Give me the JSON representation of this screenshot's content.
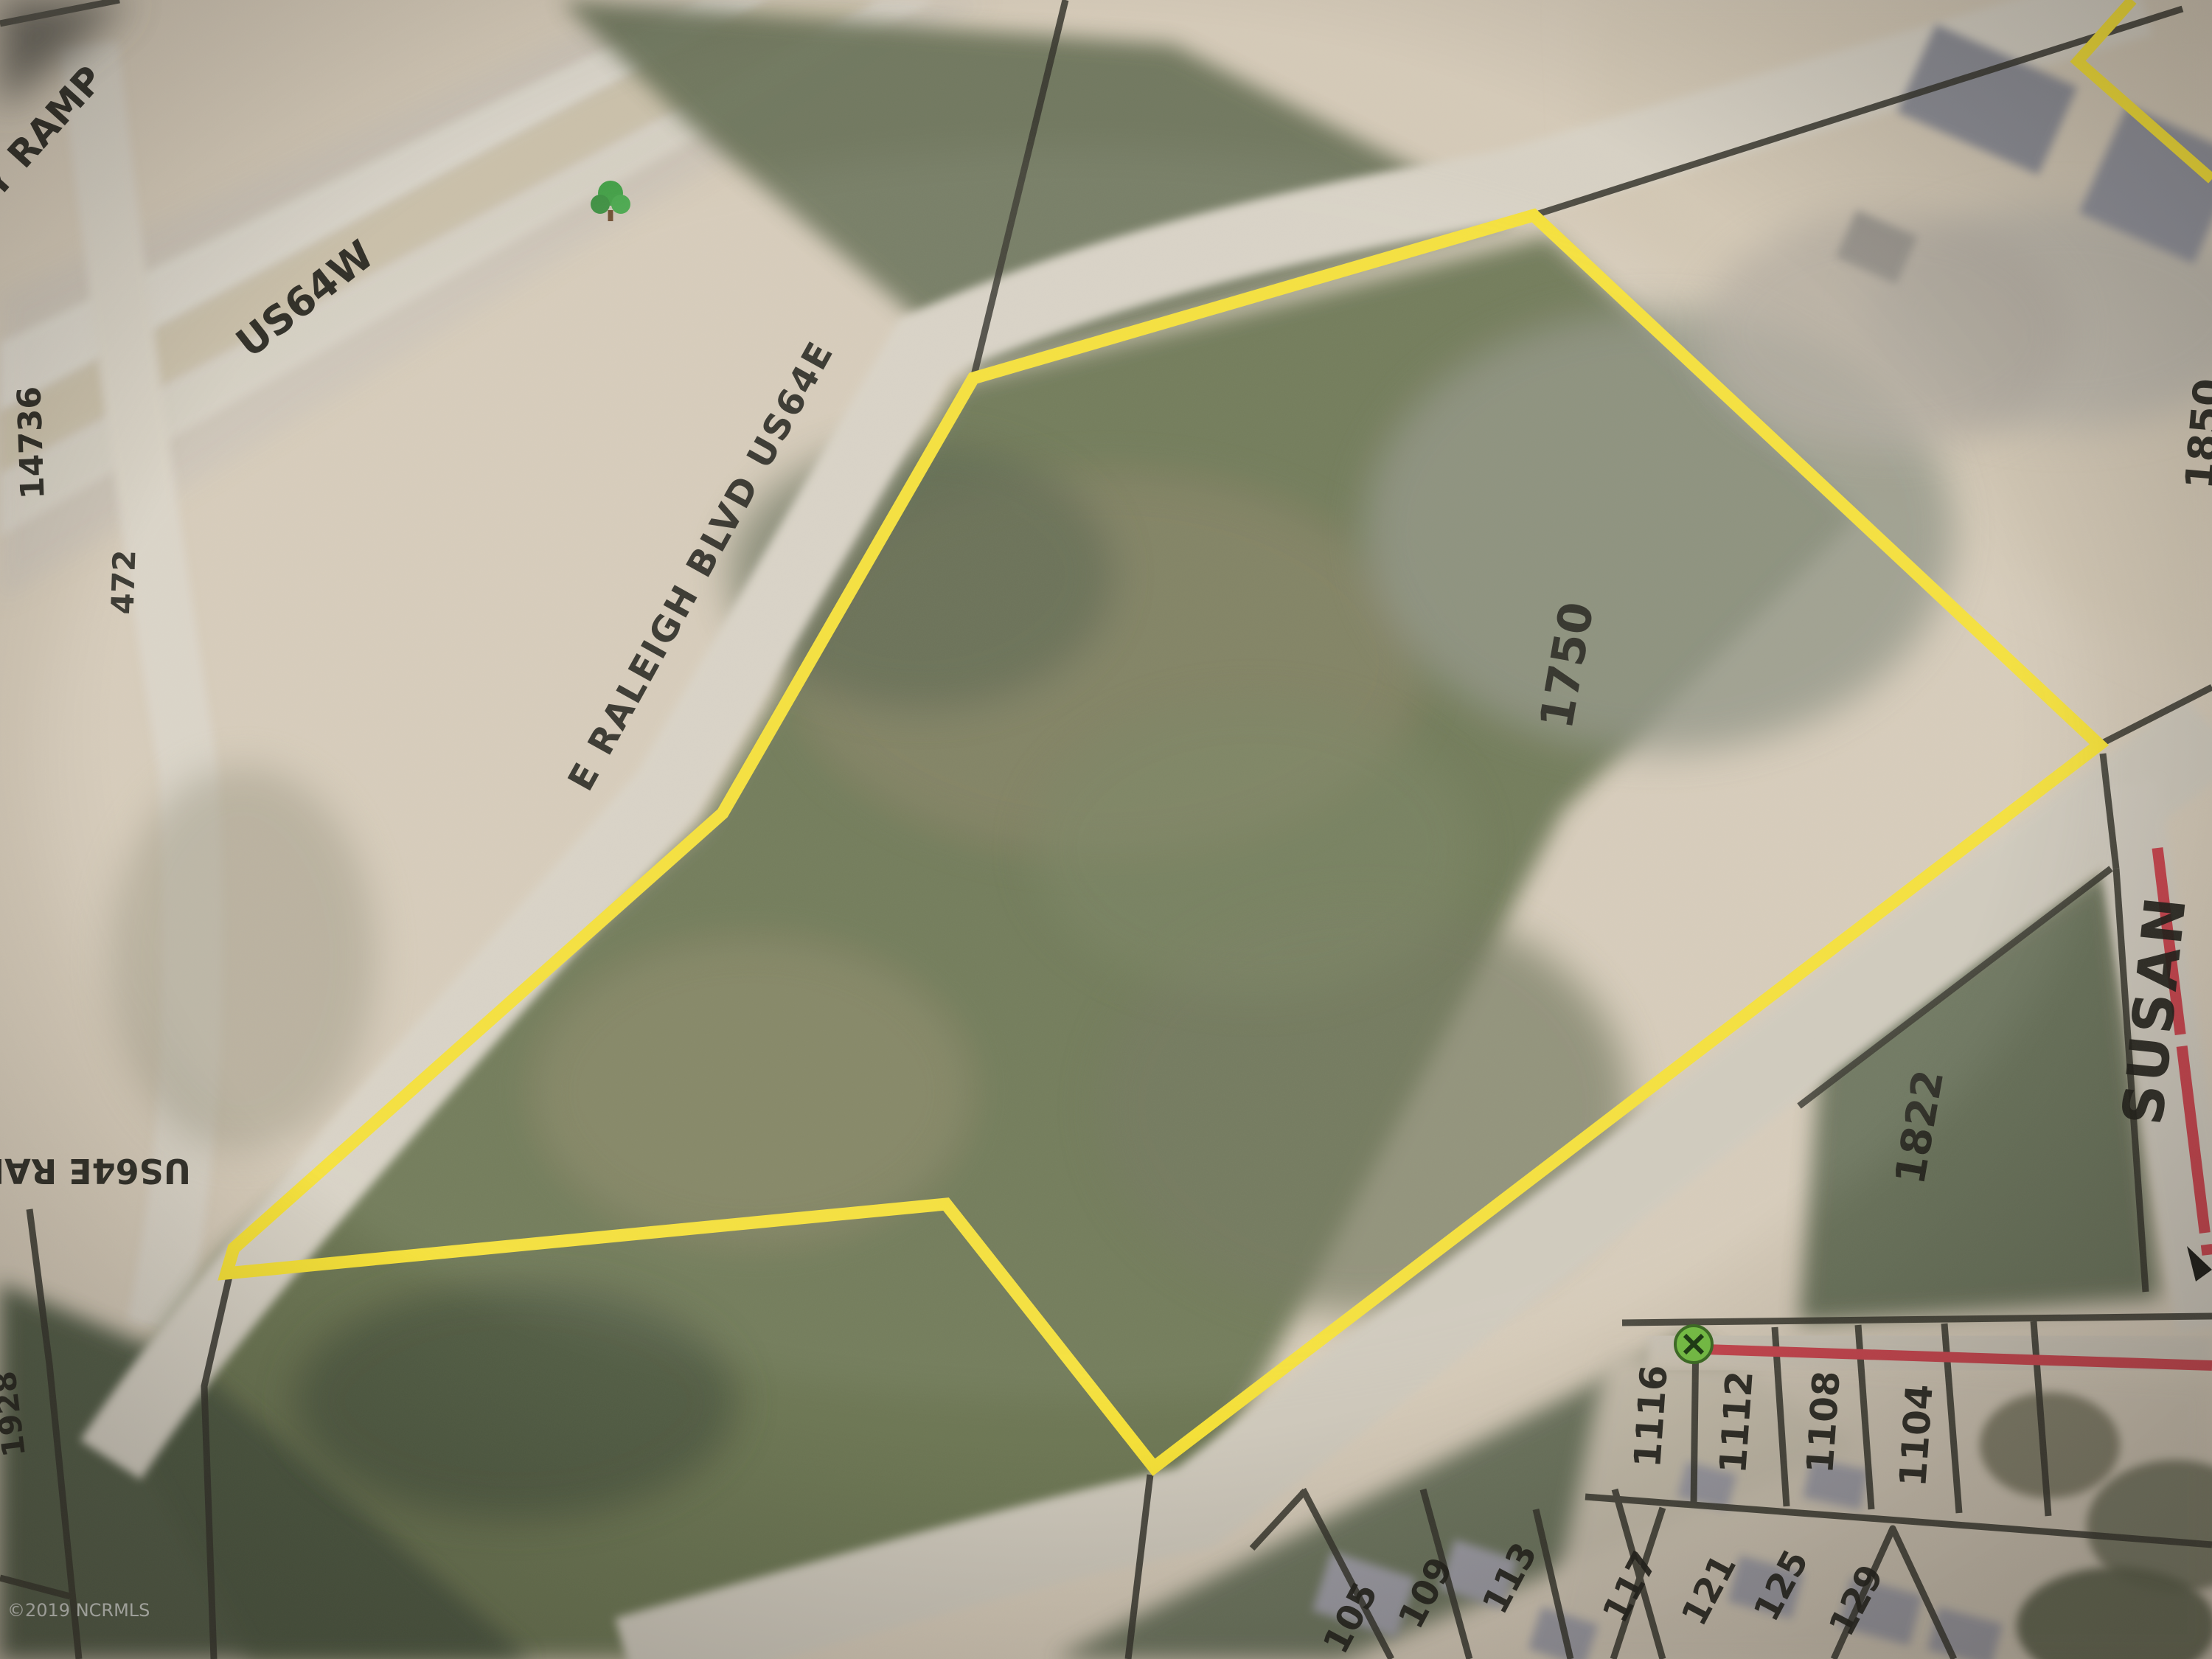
{
  "map": {
    "watermark": "©2019 NCRMLS",
    "streets": {
      "ramp": "Y RAMP",
      "us64w": "US64W",
      "e_raleigh_blvd": "E RALEIGH BLVD US64E",
      "us64e_raleigh_partial": "US64E RAL",
      "susan": "SUSAN"
    },
    "route_segment_ids": {
      "segment_a": "14736",
      "segment_b": "472"
    },
    "parcels": {
      "subject_parcel": "1750",
      "neighbor_right": "1822",
      "neighbor_left": "1928",
      "edge_partial": "1850",
      "front_row": [
        "1116",
        "1112",
        "1108",
        "1104"
      ],
      "second_row": [
        "117",
        "121",
        "125",
        "129"
      ],
      "bottom_row": [
        "105",
        "109",
        "113"
      ]
    },
    "colors": {
      "parcel_highlight": "#f6e136",
      "street_centerline": "#c8454e",
      "poi_marker": "#76c044"
    }
  }
}
